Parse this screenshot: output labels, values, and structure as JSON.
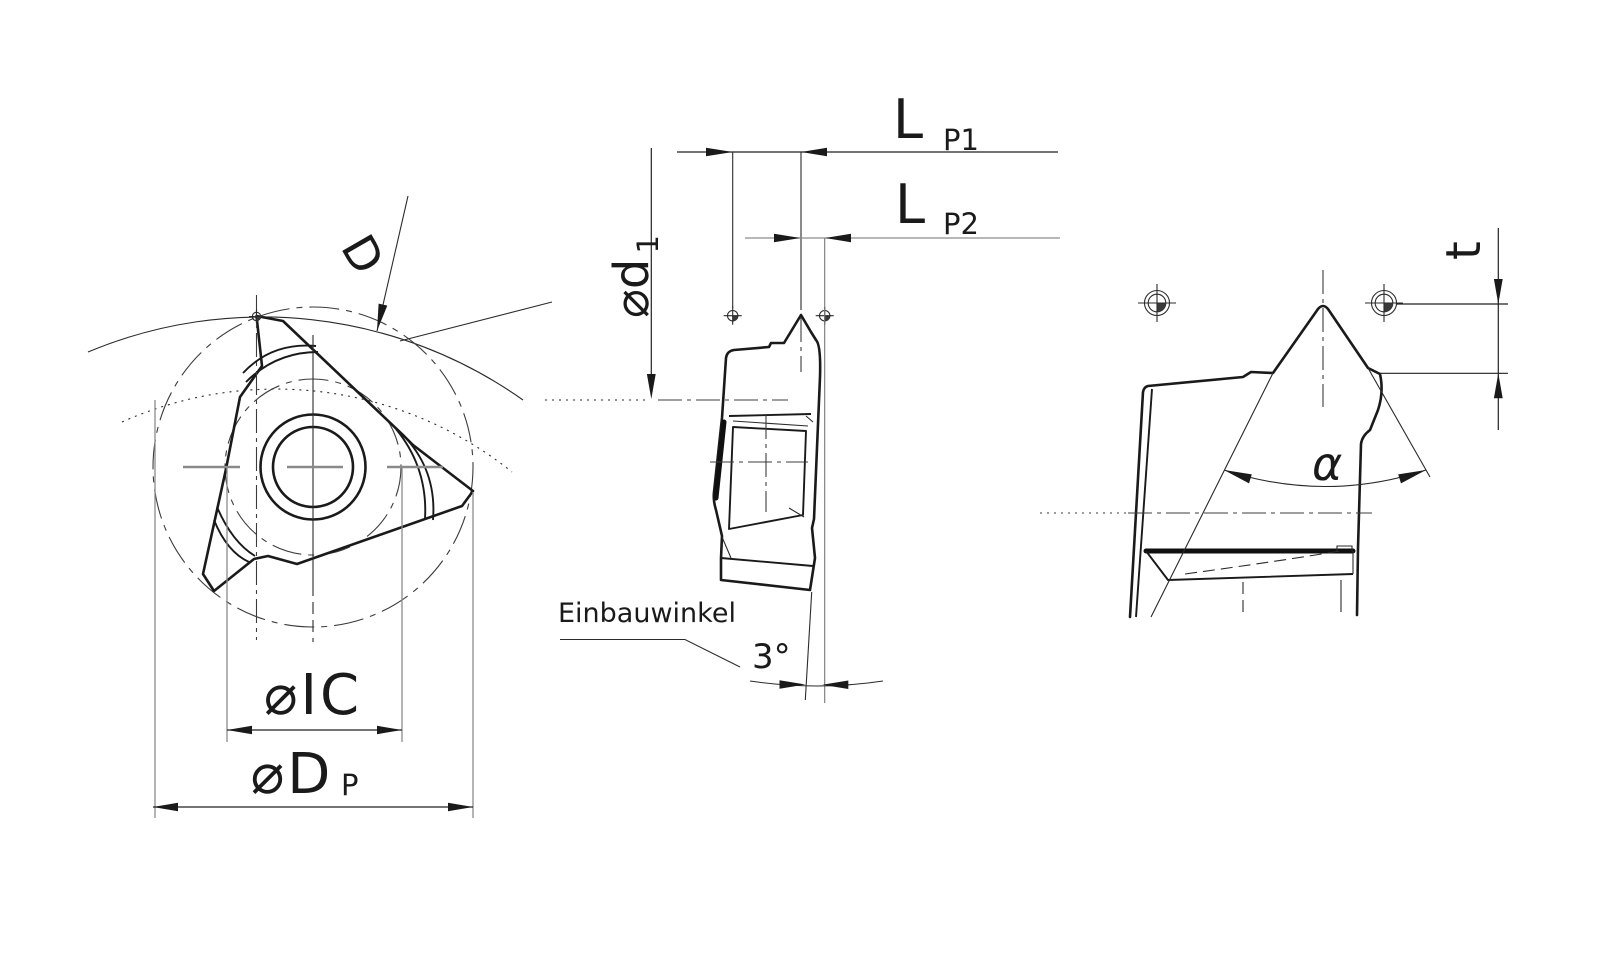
{
  "drawing": {
    "background_color": "#ffffff",
    "line_color": "#1a1a1a",
    "centerline_color": "#8c8c8c",
    "front_view": {
      "d_label": "D",
      "ic_dim": "⌀IC",
      "dp_dim_main": "⌀D",
      "dp_dim_sub": "P"
    },
    "side_view": {
      "lp1_main": "L",
      "lp1_sub": "P1",
      "lp2_main": "L",
      "lp2_sub": "P2",
      "d1_main": "⌀d",
      "d1_sub": "1",
      "install_angle_label": "Einbauwinkel",
      "install_angle_value": "3°"
    },
    "profile_view": {
      "flank_angle_label": "α",
      "depth_label": "t"
    }
  }
}
